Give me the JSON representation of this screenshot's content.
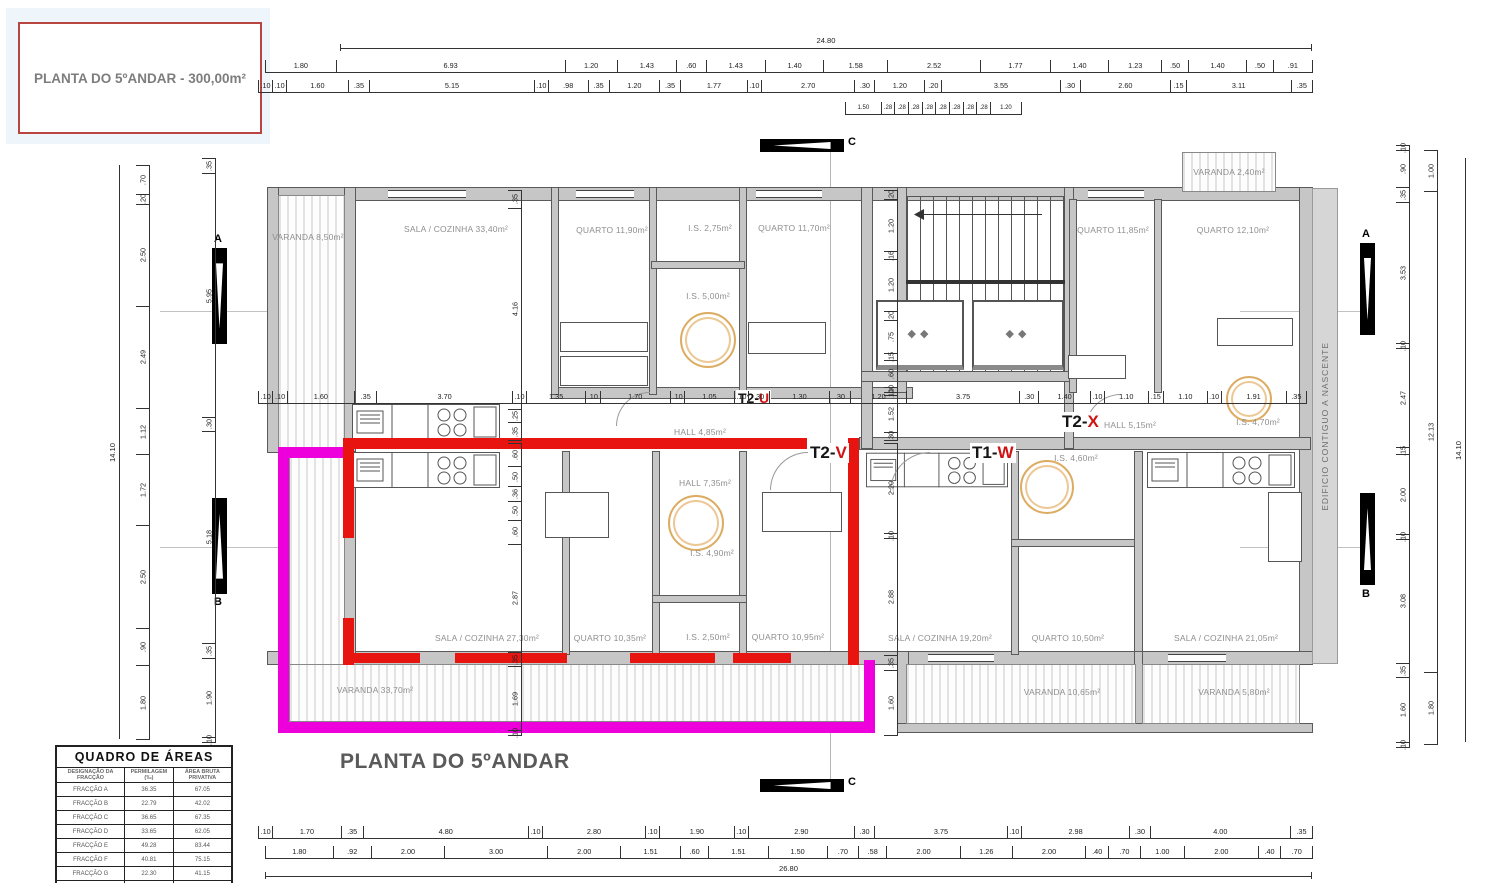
{
  "title_box": {
    "text": "PLANTA DO 5ºANDAR - 300,00m²"
  },
  "plan_title": "PLANTA DO 5ºANDAR",
  "side_note": "EDIFICIO CONTIGUO A NASCENTE",
  "icons": {
    "elevator_icon": "◆◆"
  },
  "section_markers": {
    "a": "A",
    "b": "B",
    "c": "C"
  },
  "units": {
    "t2u": {
      "prefix": "T2-",
      "letter": "U"
    },
    "t2v": {
      "prefix": "T2-",
      "letter": "V"
    },
    "t1w": {
      "prefix": "T1-",
      "letter": "W"
    },
    "t2x": {
      "prefix": "T2-",
      "letter": "X"
    }
  },
  "rooms": {
    "varanda_850": "VARANDA 8,50m²",
    "sala_3340": "SALA / COZINHA 33,40m²",
    "quarto_1190": "QUARTO 11,90m²",
    "is_275": "I.S. 2,75m²",
    "quarto_1170": "QUARTO 11,70m²",
    "is_500": "I.S. 5,00m²",
    "quarto_1185": "QUARTO 11,85m²",
    "quarto_1210": "QUARTO 12,10m²",
    "varanda_240": "VARANDA 2,40m²",
    "hall_485": "HALL 4,85m²",
    "hall_515": "HALL 5,15m²",
    "is_470": "I.S. 4,70m²",
    "hall_735": "HALL 7,35m²",
    "is_490": "I.S. 4,90m²",
    "sala_2730": "SALA / COZINHA 27,30m²",
    "quarto_1035": "QUARTO 10,35m²",
    "is_250": "I.S. 2,50m²",
    "quarto_1095": "QUARTO 10,95m²",
    "is_460": "I.S. 4,60m²",
    "sala_1920": "SALA / COZINHA 19,20m²",
    "quarto_1050": "QUARTO 10,50m²",
    "sala_2105": "SALA / COZINHA 21,05m²",
    "varanda_3370": "VARANDA 33,70m²",
    "varanda_1065": "VARANDA 10,65m²",
    "varanda_580": "VARANDA 5,80m²"
  },
  "dims": {
    "top_total": "24.80",
    "bottom_total": "26.80",
    "left_total": "14.10",
    "right_total": "14.10",
    "top_row1": [
      "1.80",
      "6.93",
      "1.20",
      "1.43",
      ".60",
      "1.43",
      "1.40",
      "1.58",
      "2.52",
      "1.77",
      "1.40",
      "1.23",
      ".50",
      "1.40",
      ".50",
      ".91"
    ],
    "top_row2": [
      ".10",
      ".10",
      "1.60",
      ".35",
      "5.15",
      ".10",
      ".98",
      ".35",
      "1.20",
      ".35",
      "1.77",
      ".10",
      "2.70",
      ".30",
      "1.20",
      ".20",
      "3.55",
      ".30",
      "2.60",
      ".15",
      "3.11",
      ".35"
    ],
    "top_sub": [
      "1.50",
      ".28",
      ".28",
      ".28",
      ".28",
      ".28",
      ".28",
      ".28",
      ".28",
      "1.20"
    ],
    "mid_rowA": [
      ".10",
      ".10",
      "1.60",
      ".35",
      "3.70",
      ".10",
      "1.35",
      ".10",
      "1.70",
      ".10",
      "1.05",
      ".10"
    ],
    "mid_rowB": [
      ".30",
      "1.30",
      ".30",
      "1.20"
    ],
    "mid_rowC": [
      "3.75",
      ".30",
      "1.40",
      ".10",
      "1.10",
      ".15",
      "1.10",
      ".10",
      "1.91",
      ".35"
    ],
    "bot_row1": [
      ".10",
      "1.70",
      ".35",
      "4.80",
      ".10",
      "2.80",
      ".10",
      "1.90",
      ".10",
      "2.90",
      ".30",
      "3.75",
      ".10",
      "2.98",
      ".30",
      "4.00",
      ".35"
    ],
    "bot_row2": [
      "1.80",
      ".92",
      "2.00",
      "3.00",
      "2.00",
      "1.51",
      ".60",
      "1.51",
      "1.50",
      ".70",
      ".58",
      "2.00",
      "1.26",
      "2.00",
      ".40",
      ".70",
      "1.00",
      "2.00",
      ".40",
      ".70"
    ],
    "left_col1": [
      ".70",
      ".20",
      "2.50",
      "2.49",
      "1.12",
      "1.72",
      "2.50",
      ".90",
      "1.80"
    ],
    "left_col2": [
      ".35",
      "5.95",
      ".30",
      "5.18",
      ".35",
      "1.90",
      ".10"
    ],
    "right_col1": [
      ".10",
      ".90",
      ".35",
      "3.53",
      ".10",
      "2.47",
      ".15",
      "2.00",
      ".10",
      "3.08",
      ".35",
      "1.60",
      ".10"
    ],
    "right_col2": [
      "1.00",
      "12.13",
      "1.80"
    ],
    "vplan_1": [
      ".35",
      "4.16",
      ".25",
      ".35"
    ],
    "vplan_2": [
      ".60",
      ".50",
      ".36",
      ".50",
      ".60",
      "2.87",
      ".35",
      "1.69",
      ".10"
    ],
    "vstair": [
      ".20",
      "1.20",
      ".16",
      "1.20",
      ".20",
      ".75",
      ".15",
      ".60",
      ".10"
    ],
    "vcore": [
      ".10",
      "1.52",
      ".30"
    ],
    "vright_lower": [
      "2.20",
      ".10",
      "2.88",
      ".35",
      "1.60"
    ]
  },
  "areas_table": {
    "title": "QUADRO DE ÁREAS",
    "headers": [
      "DESIGNAÇÃO DA FRACÇÃO",
      "PERMILAGEM (‰)",
      "ÁREA BRUTA PRIVATIVA"
    ],
    "rows": [
      [
        "FRACÇÃO A",
        "36.35",
        "67.05"
      ],
      [
        "FRACÇÃO B",
        "22.79",
        "42.02"
      ],
      [
        "FRACÇÃO C",
        "36.65",
        "67.35"
      ],
      [
        "FRACÇÃO D",
        "33.65",
        "62.05"
      ],
      [
        "FRACÇÃO E",
        "49.28",
        "83.44"
      ],
      [
        "FRACÇÃO F",
        "40.81",
        "75.15"
      ],
      [
        "FRACÇÃO G",
        "22.30",
        "41.15"
      ],
      [
        "FRACÇÃO H",
        "36.46",
        "67.05"
      ],
      [
        "FRACÇÃO I",
        "",
        ""
      ]
    ]
  }
}
